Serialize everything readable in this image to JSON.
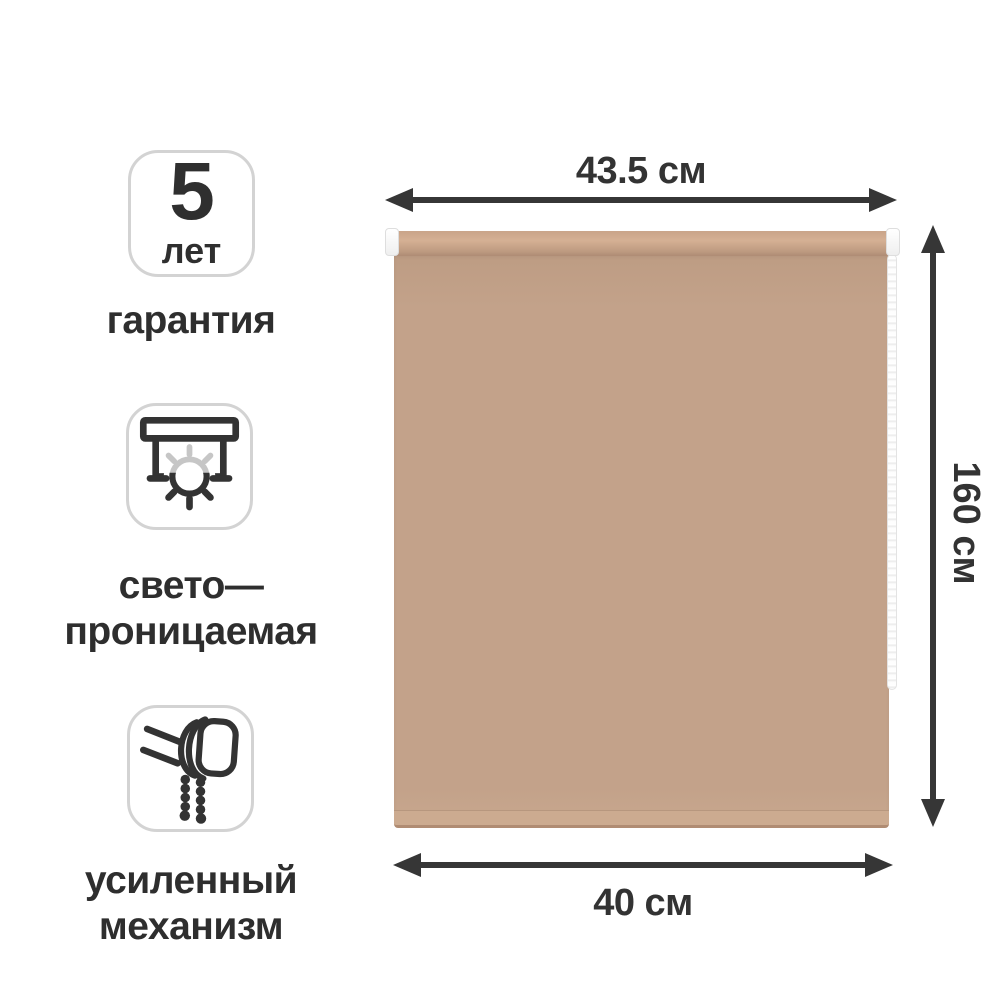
{
  "page": {
    "background": "#ffffff"
  },
  "features": {
    "warranty": {
      "number": "5",
      "unit": "лет",
      "label": "гарантия"
    },
    "light_permeable": {
      "line1": "свето—",
      "line2": "проницаемая"
    },
    "mechanism": {
      "line1": "усиленный",
      "line2": "механизм"
    }
  },
  "dimensions": {
    "top_width": "43.5 см",
    "height": "160 см",
    "bottom_width": "40 см"
  },
  "product": {
    "type": "roller-blind",
    "fabric_color": "#c3a28a",
    "annotation_color": "#363636",
    "badge_border_color": "#d3d3d3",
    "icon_light_ray_color": "#c6c6c6"
  }
}
